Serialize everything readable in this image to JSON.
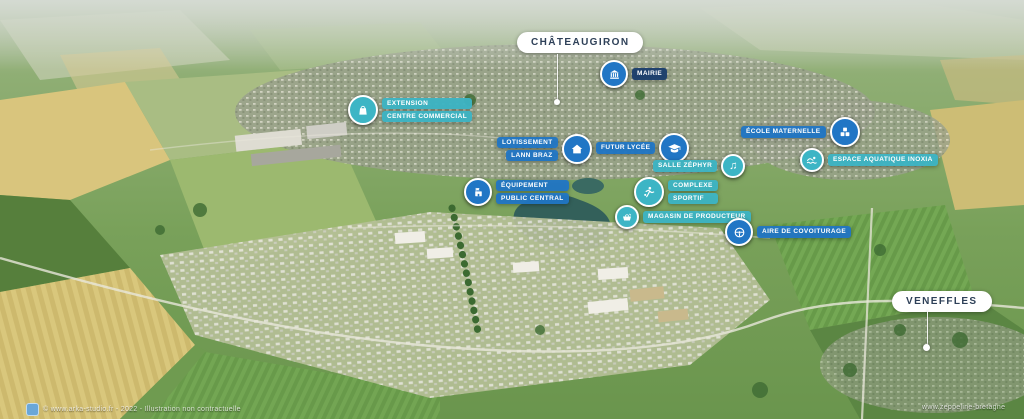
{
  "place_labels": {
    "chateaugiron": "CHÂTEAUGIRON",
    "veneffles": "VENEFFLES"
  },
  "markers": [
    {
      "id": "extension-centre-commercial",
      "lines": [
        "EXTENSION",
        "CENTRE COMMERCIAL"
      ],
      "icon": "shopping-bag-icon",
      "color": "teal"
    },
    {
      "id": "mairie",
      "lines": [
        "MAIRIE"
      ],
      "icon": "town-hall-icon",
      "color": "navy"
    },
    {
      "id": "lotissement-lann-braz",
      "lines": [
        "LOTISSEMENT",
        "LANN BRAZ"
      ],
      "icon": "house-icon",
      "color": "blue"
    },
    {
      "id": "futur-lycee",
      "lines": [
        "FUTUR LYCÉE"
      ],
      "icon": "graduation-cap-icon",
      "color": "blue"
    },
    {
      "id": "ecole-maternelle",
      "lines": [
        "ÉCOLE MATERNELLE"
      ],
      "icon": "toy-blocks-icon",
      "color": "blue"
    },
    {
      "id": "espace-aquatique-inoxia",
      "lines": [
        "ESPACE AQUATIQUE INOXIA"
      ],
      "icon": "swimmer-icon",
      "color": "teal"
    },
    {
      "id": "salle-zephyr",
      "lines": [
        "SALLE ZÉPHYR"
      ],
      "icon": "music-notes-icon",
      "color": "teal"
    },
    {
      "id": "equipement-public-central",
      "lines": [
        "ÉQUIPEMENT",
        "PUBLIC CENTRAL"
      ],
      "icon": "public-building-icon",
      "color": "blue"
    },
    {
      "id": "complexe-sportif",
      "lines": [
        "COMPLEXE",
        "SPORTIF"
      ],
      "icon": "athlete-icon",
      "color": "teal"
    },
    {
      "id": "magasin-de-producteur",
      "lines": [
        "MAGASIN DE PRODUCTEUR"
      ],
      "icon": "produce-basket-icon",
      "color": "teal"
    },
    {
      "id": "aire-de-covoiturage",
      "lines": [
        "AIRE DE COVOITURAGE"
      ],
      "icon": "steering-wheel-icon",
      "color": "blue"
    }
  ],
  "colors": {
    "marker_blue": "#2176c5",
    "marker_teal": "#3db5c5",
    "mairie_navy": "#1b3e6e",
    "place_pill_bg": "#ffffff",
    "place_pill_text": "#2e4058"
  },
  "watermarks": {
    "left": "© www.arka-studio.fr - 2022 - Illustration non contractuelle",
    "right": "www.zeppeline-bretagne"
  },
  "music_note_glyph": "♫"
}
